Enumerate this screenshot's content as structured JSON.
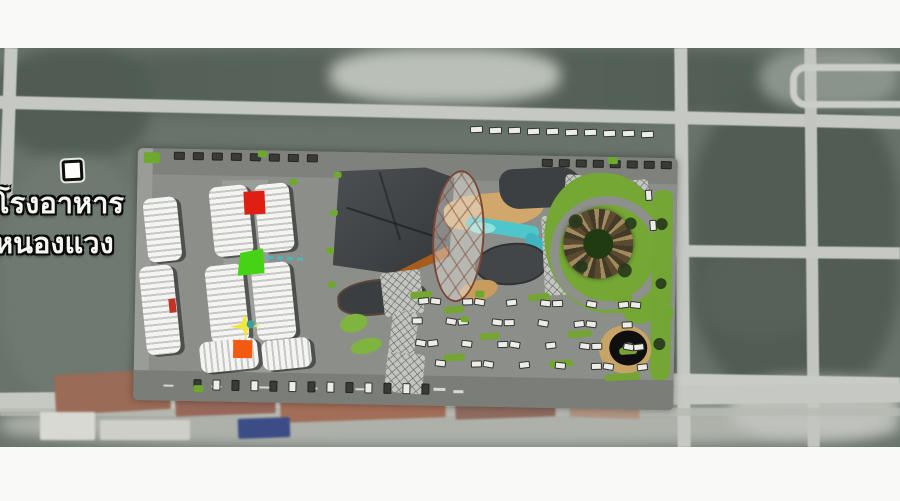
{
  "video_frame": {
    "letterbox_color": "#f9f9f8"
  },
  "map": {
    "poi": {
      "label_line1": "โรงอาหาร",
      "label_line2": "หนองแวง",
      "marker_style": "white-square"
    }
  },
  "site_plan": {
    "markers": [
      {
        "id": "marker-red-square",
        "color": "#e01f14"
      },
      {
        "id": "marker-green-square",
        "color": "#46d316"
      },
      {
        "id": "marker-yellow-star",
        "color": "#f0e93a"
      },
      {
        "id": "marker-orange-square",
        "color": "#f25a12"
      },
      {
        "id": "marker-teal-dot",
        "color": "#3f9fa0"
      }
    ],
    "colors": {
      "paving": "#8b8e89",
      "building_white": "#f4f4f2",
      "main_hall_roof": "#45484a",
      "accent_orange": "#a85c1c",
      "water": "#4fc6ca",
      "lawn": "#74a734",
      "path_tan": "#d2a76b",
      "canopy_outline": "#7c4636",
      "round_pavilion": "#0f0f0f"
    },
    "parking": {
      "inner_lot_cars": 37,
      "perimeter_cars": 29,
      "ring_road_cars": 2
    }
  },
  "surroundings": {
    "street_trucks": 10
  }
}
